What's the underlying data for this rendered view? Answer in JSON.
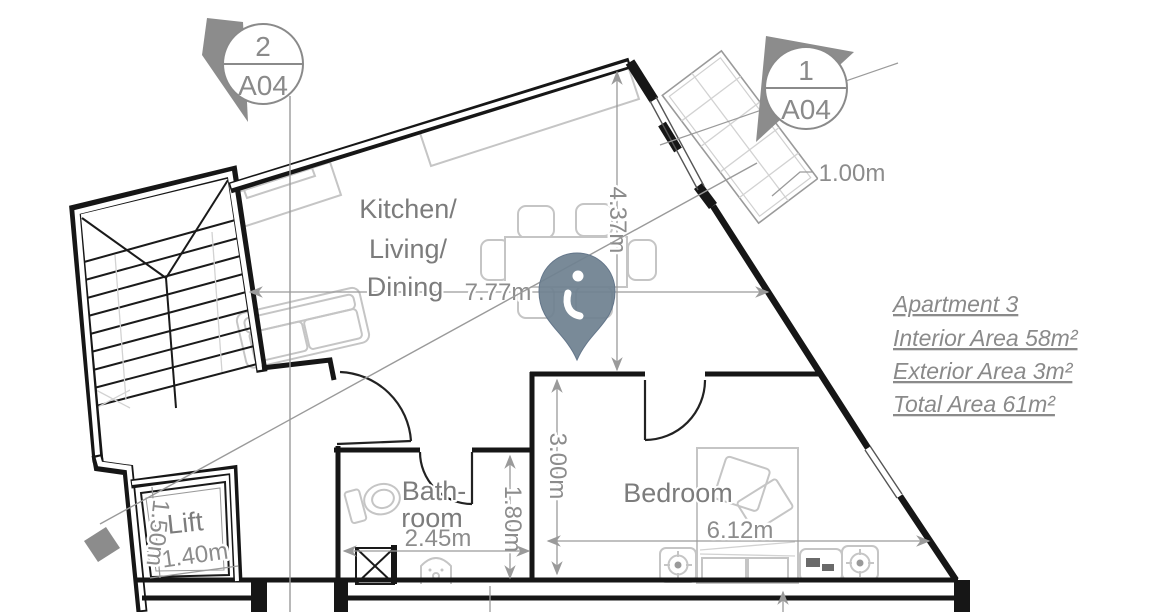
{
  "apartment_info": {
    "title": "Apartment 3",
    "interior_area": "Interior Area 58m²",
    "exterior_area": "Exterior Area 3m²",
    "total_area": "Total Area 61m²"
  },
  "rooms": {
    "kitchen_line1": "Kitchen/",
    "kitchen_line2": "Living/",
    "kitchen_line3": "Dining",
    "bedroom": "Bedroom",
    "bathroom_line1": "Bath-",
    "bathroom_line2": "room",
    "lift": "Lift"
  },
  "dimensions": {
    "living_width": "7.77m",
    "living_height": "4.37m",
    "bedroom_width": "6.12m",
    "bedroom_height": "3.00m",
    "bathroom_width": "2.45m",
    "bathroom_height": "1.80m",
    "lift_width": "1.40m",
    "lift_height": "1.50m",
    "balcony_depth": "1.00m"
  },
  "section_markers": {
    "marker_2": {
      "number": "2",
      "sheet": "A04"
    },
    "marker_1": {
      "number": "1",
      "sheet": "A04"
    }
  },
  "map_pin": {
    "icon": "location-pin",
    "glyph": "i"
  },
  "colors": {
    "wall": "#161616",
    "furniture": "#c5c5c5",
    "dimension_text": "#8c8c8c",
    "room_text": "#7c7c7c",
    "marker_fill": "#8c8c8c",
    "pin": "#6f8190"
  }
}
